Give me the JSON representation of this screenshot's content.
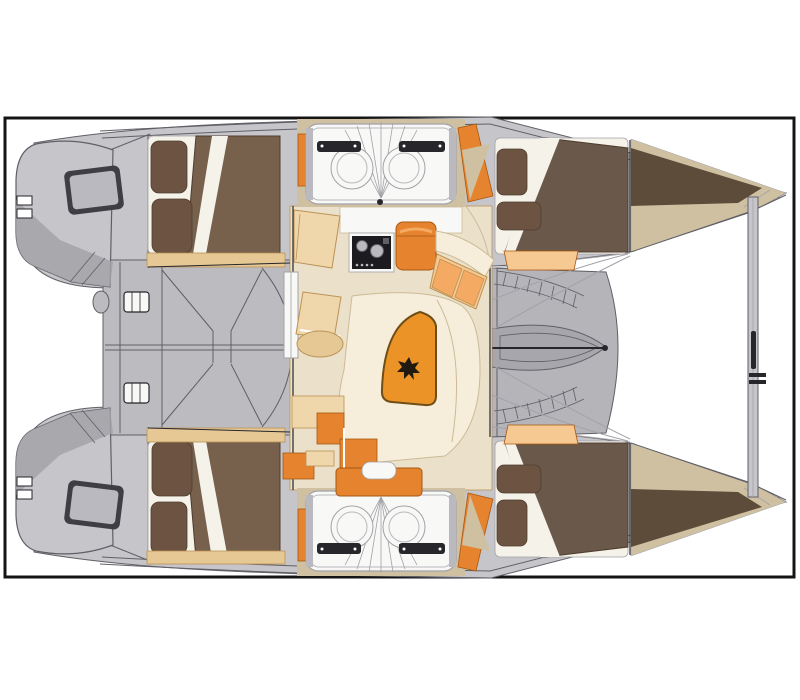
{
  "plan": {
    "title": "Catamaran interior layout plan — top view",
    "type": "floor-plan",
    "legend": [
      {
        "id": "port-aft-cabin",
        "label": "aft double berth (port)"
      },
      {
        "id": "port-bathroom",
        "label": "bathroom vanity (port)"
      },
      {
        "id": "port-fwd-cabin",
        "label": "forward double berth (port)"
      },
      {
        "id": "starboard-aft-cabin",
        "label": "aft double berth (starboard)"
      },
      {
        "id": "starboard-bathroom",
        "label": "bathroom vanity (starboard)"
      },
      {
        "id": "starboard-fwd-cabin",
        "label": "forward double berth (starboard)"
      },
      {
        "id": "saloon",
        "label": "saloon with galley and dinette"
      },
      {
        "id": "cockpit",
        "label": "aft cockpit"
      },
      {
        "id": "foredeck",
        "label": "foredeck / trampoline"
      },
      {
        "id": "crossbeam",
        "label": "forward crossbeam"
      }
    ]
  },
  "palette": {
    "paper": "#ffffff",
    "frame": "#141414",
    "hullGray": "#c6c6ca",
    "hullShade": "#a2a2a8",
    "cockpitGray": "#bcbcc0",
    "foredeckGray": "#b4b4b9",
    "lensGray": "#a6a6ac",
    "deckLine": "#5f5f66",
    "ink": "#26262b",
    "windowFrame": "#3e3e44",
    "windowGlass": "#b9b9bf",
    "fittingWhite": "#f8f8f6",
    "sheetWhite": "#f5f2ea",
    "pillowBrown": "#6d5442",
    "bedBlanket": "#77604c",
    "bedBlanket2": "#6a594a",
    "bedEdge": "#4e3d2d",
    "woodTan": "#e5c894",
    "deckTan": "#cfc0a2",
    "bowBrown": "#5e4c3a",
    "orange": "#e5832f",
    "orangeLight": "#f4aa63",
    "orangeEdge": "#a85812",
    "peach": "#f6c892",
    "tanCabinet": "#f0d7ab",
    "tanEdge": "#bb9255",
    "saloonFloor": "#ebe0c9",
    "cream": "#f6eedb",
    "creamLine": "#cbbb97",
    "stoveBlack": "#1c1c20",
    "tableOrange": "#ec9327",
    "tableEdge": "#6e4e16",
    "emblemDark": "#211a10"
  }
}
